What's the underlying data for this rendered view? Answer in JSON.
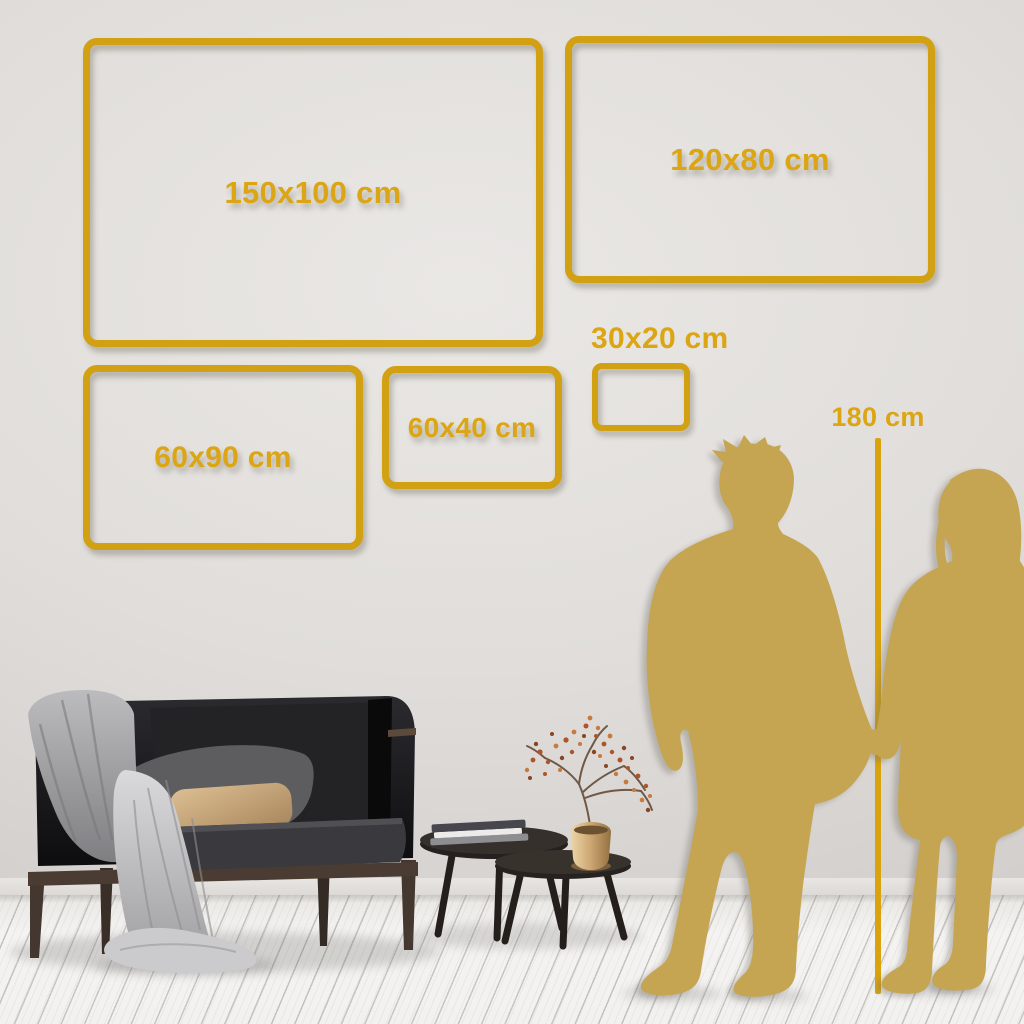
{
  "size_guide": {
    "frames": [
      {
        "id": "150x100",
        "label": "150x100 cm"
      },
      {
        "id": "120x80",
        "label": "120x80 cm"
      },
      {
        "id": "60x90",
        "label": "60x90 cm"
      },
      {
        "id": "60x40",
        "label": "60x40 cm"
      },
      {
        "id": "30x20",
        "label": "30x20 cm"
      }
    ],
    "reference": {
      "label": "180 cm"
    }
  },
  "colors": {
    "accent_gold": "#d2a013",
    "silhouette_gold": "#c5a552",
    "wall": "#dedbd8",
    "floor": "#f2f1ef"
  }
}
